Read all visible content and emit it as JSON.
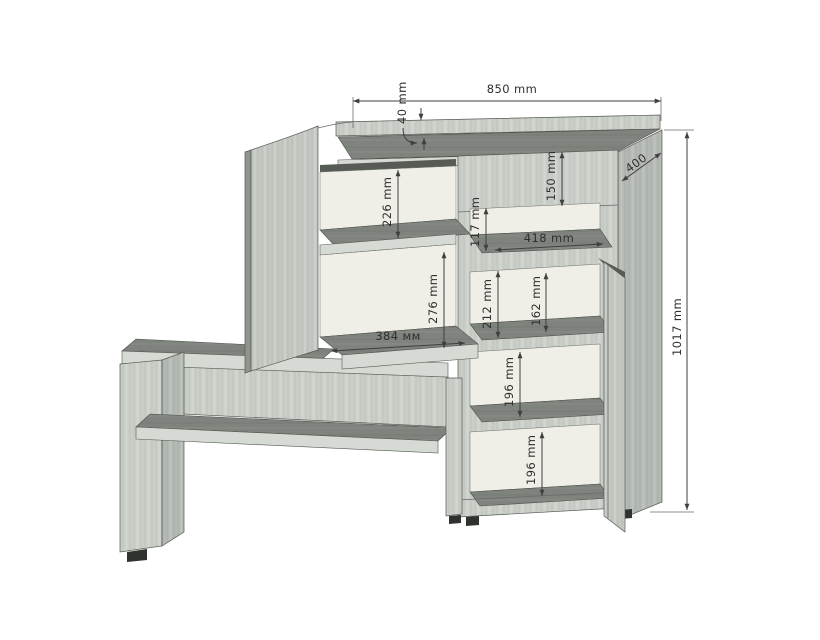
{
  "drawing": {
    "kind": "furniture-technical-drawing",
    "subject": "hallway bench with shelf cabinet, isometric view with dimensions",
    "units": "mm",
    "colors": {
      "background": "#ffffff",
      "wood_face": "#c9cec8",
      "wood_side": "#b4bab3",
      "wood_door": "#c3c8c2",
      "surface_dark": "#7e837d",
      "interior_back": "#f0efe7",
      "edge_light": "#d6dad4",
      "dim_line": "#3f3f3f",
      "dim_text": "#2f2f2f"
    },
    "dims": {
      "d850": "850 mm",
      "d40": "40 mm",
      "d400": "400",
      "d1017": "1017 mm",
      "d150": "150 mm",
      "d226": "226 mm",
      "d117": "117 mm",
      "d418": "418 mm",
      "d276": "276 mm",
      "d384": "384 мм",
      "d212": "212 mm",
      "d162": "162 mm",
      "d196_upper": "196 mm",
      "d196_lower": "196 mm"
    }
  }
}
